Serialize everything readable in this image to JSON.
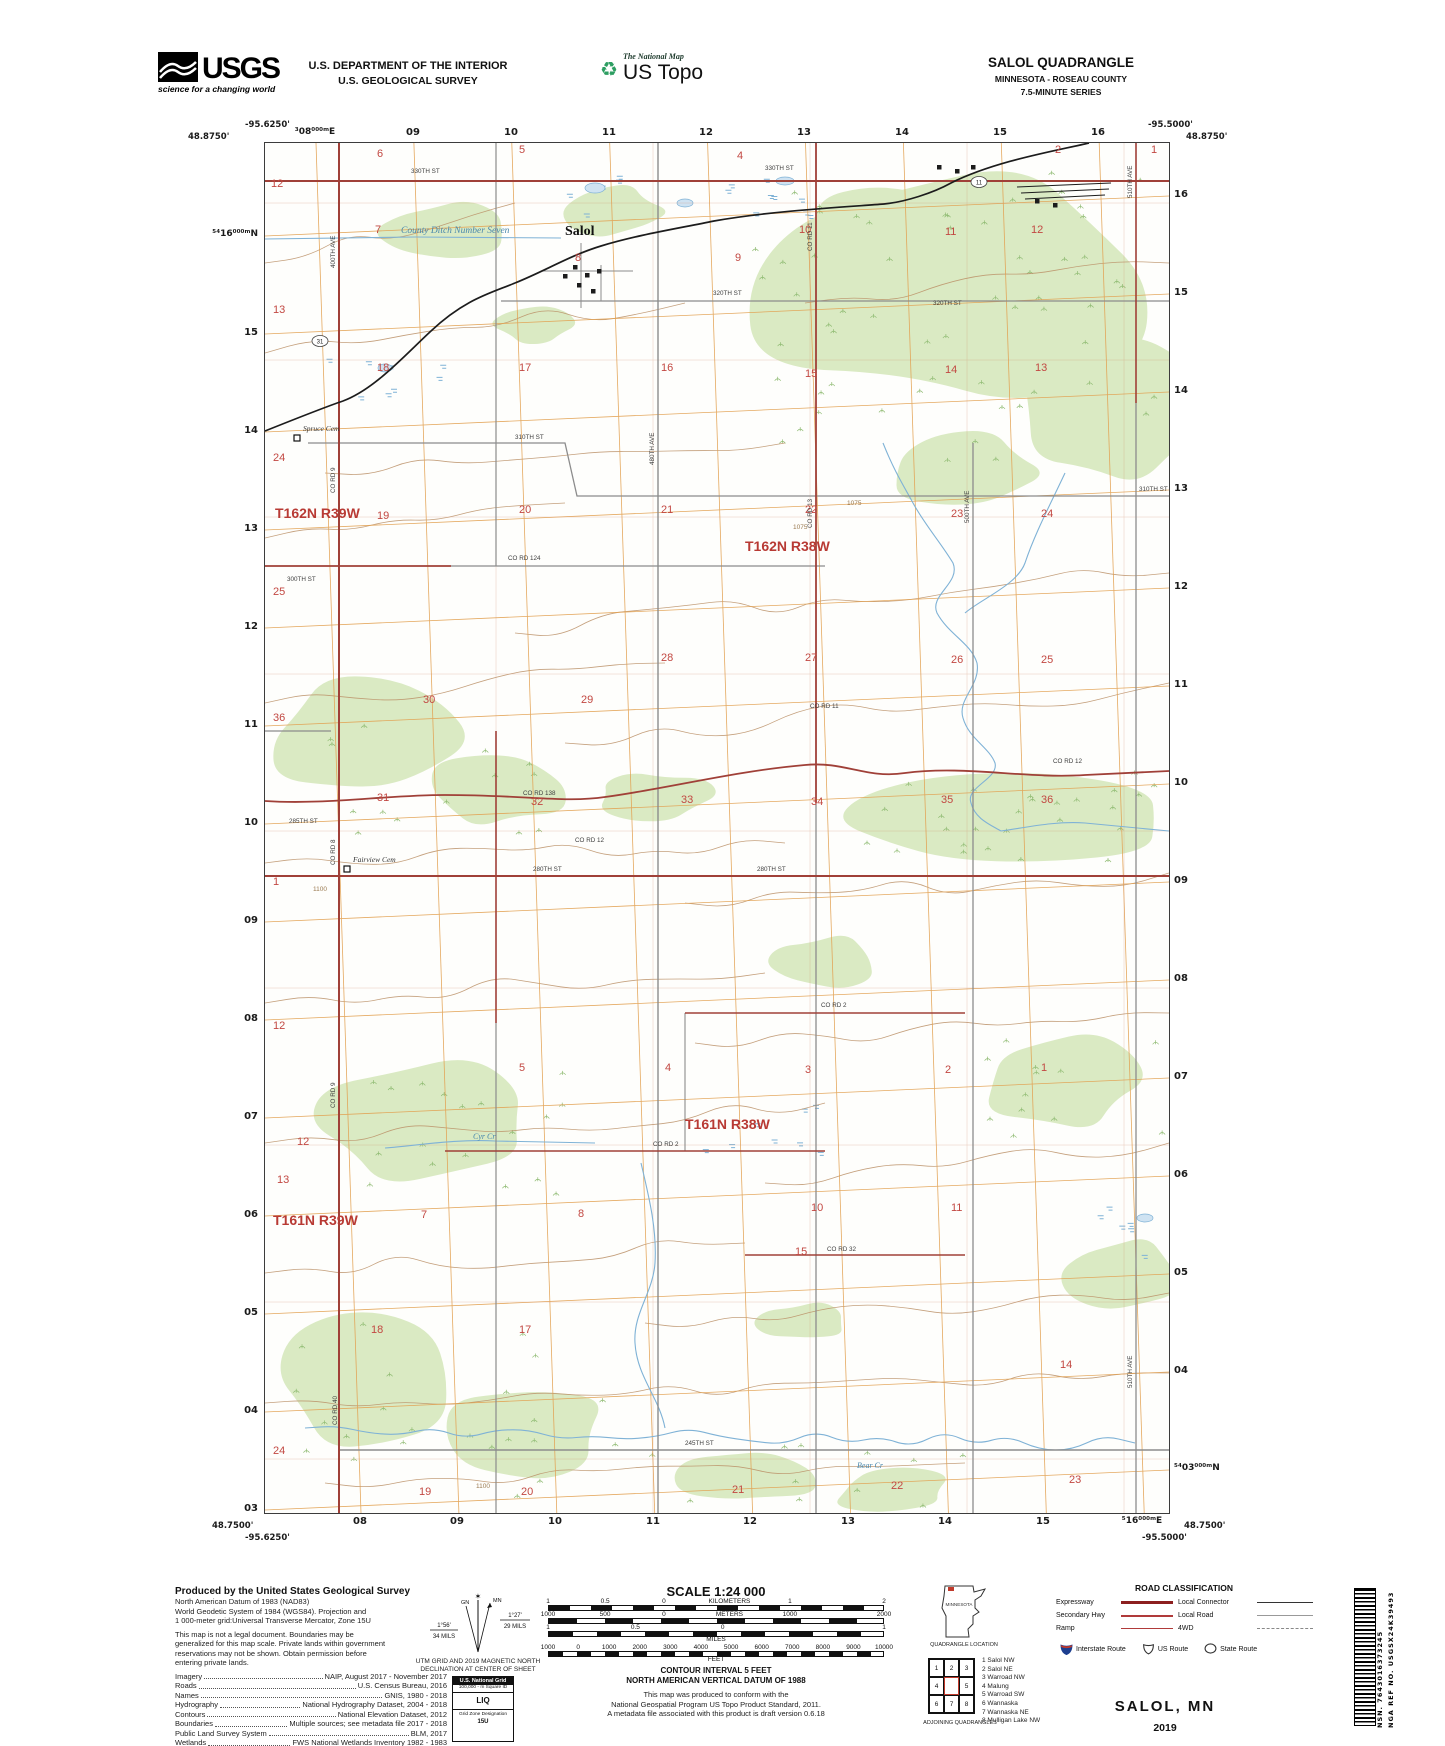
{
  "colors": {
    "veg": "#daeac3",
    "tuft": "#8fbb72",
    "contour": "#bb9067",
    "contour_label": "#9a7a50",
    "water": "#7fb2d6",
    "water_text": "#4a88ad",
    "grid": "#e2a050",
    "section_grid": "#d08a6a",
    "road_red": "#a04038",
    "road_gray": "#8c8c8c",
    "rail": "#1c1c1c",
    "section_num": "#c24842",
    "township": "#b83a34"
  },
  "header": {
    "usgs": {
      "brand": "USGS",
      "tagline": "science for a changing world"
    },
    "department_line1": "U.S. DEPARTMENT OF THE INTERIOR",
    "department_line2": "U.S. GEOLOGICAL SURVEY",
    "national_map": {
      "line1": "The National Map",
      "line2": "US Topo",
      "glyph": "♻"
    },
    "quadrangle": {
      "title": "SALOL QUADRANGLE",
      "subtitle1": "MINNESOTA - ROSEAU COUNTY",
      "subtitle2": "7.5-MINUTE SERIES"
    }
  },
  "map_frame": {
    "corners": {
      "top_left_lon": "-95.6250'",
      "top_left_lat": "48.8750'",
      "top_right_lon": "-95.5000'",
      "top_right_lat": "48.8750'",
      "bottom_left_lat": "48.7500'",
      "bottom_left_lon": "-95.6250'",
      "bottom_right_lat": "48.7500'",
      "bottom_right_lon": "-95.5000'"
    },
    "top_ticks": [
      {
        "t": "³08⁰⁰⁰ᵐE",
        "x": 51
      },
      {
        "t": "09",
        "x": 149
      },
      {
        "t": "10",
        "x": 247
      },
      {
        "t": "11",
        "x": 345
      },
      {
        "t": "12",
        "x": 442
      },
      {
        "t": "13",
        "x": 540
      },
      {
        "t": "14",
        "x": 638
      },
      {
        "t": "15",
        "x": 736
      },
      {
        "t": "16",
        "x": 834
      }
    ],
    "bottom_ticks": [
      {
        "t": "08",
        "x": 96
      },
      {
        "t": "09",
        "x": 193
      },
      {
        "t": "10",
        "x": 291
      },
      {
        "t": "11",
        "x": 389
      },
      {
        "t": "12",
        "x": 486
      },
      {
        "t": "13",
        "x": 584
      },
      {
        "t": "14",
        "x": 681
      },
      {
        "t": "15",
        "x": 779
      },
      {
        "t": "⁵16⁰⁰⁰ᵐE",
        "x": 878
      }
    ],
    "left_ticks": [
      {
        "t": "⁵⁴16⁰⁰⁰ᵐN",
        "y": 93
      },
      {
        "t": "15",
        "y": 191
      },
      {
        "t": "14",
        "y": 289
      },
      {
        "t": "13",
        "y": 387
      },
      {
        "t": "12",
        "y": 485
      },
      {
        "t": "11",
        "y": 583
      },
      {
        "t": "10",
        "y": 681
      },
      {
        "t": "09",
        "y": 779
      },
      {
        "t": "08",
        "y": 877
      },
      {
        "t": "07",
        "y": 975
      },
      {
        "t": "06",
        "y": 1073
      },
      {
        "t": "05",
        "y": 1171
      },
      {
        "t": "04",
        "y": 1269
      },
      {
        "t": "03",
        "y": 1367
      }
    ],
    "right_ticks": [
      {
        "t": "16",
        "y": 53
      },
      {
        "t": "15",
        "y": 151
      },
      {
        "t": "14",
        "y": 249
      },
      {
        "t": "13",
        "y": 347
      },
      {
        "t": "12",
        "y": 445
      },
      {
        "t": "11",
        "y": 543
      },
      {
        "t": "10",
        "y": 641
      },
      {
        "t": "09",
        "y": 739
      },
      {
        "t": "08",
        "y": 837
      },
      {
        "t": "07",
        "y": 935
      },
      {
        "t": "06",
        "y": 1033
      },
      {
        "t": "05",
        "y": 1131
      },
      {
        "t": "04",
        "y": 1229
      },
      {
        "t": "⁵⁴03⁰⁰⁰ᵐN",
        "y": 1327
      }
    ]
  },
  "map_labels": {
    "town": {
      "t": "Salol",
      "x": 300,
      "y": 92
    },
    "townships": [
      {
        "t": "T162N R39W",
        "x": 10,
        "y": 375
      },
      {
        "t": "T162N R38W",
        "x": 480,
        "y": 408
      },
      {
        "t": "T161N R39W",
        "x": 8,
        "y": 1082
      },
      {
        "t": "T161N R38W",
        "x": 420,
        "y": 986
      }
    ],
    "sections": [
      {
        "t": "12",
        "x": 6,
        "y": 44
      },
      {
        "t": "13",
        "x": 8,
        "y": 170
      },
      {
        "t": "24",
        "x": 8,
        "y": 318
      },
      {
        "t": "25",
        "x": 8,
        "y": 452
      },
      {
        "t": "36",
        "x": 8,
        "y": 578
      },
      {
        "t": "1",
        "x": 8,
        "y": 742
      },
      {
        "t": "12",
        "x": 8,
        "y": 886
      },
      {
        "t": "13",
        "x": 12,
        "y": 1040
      },
      {
        "t": "24",
        "x": 8,
        "y": 1311
      },
      {
        "t": "6",
        "x": 112,
        "y": 14
      },
      {
        "t": "5",
        "x": 254,
        "y": 10
      },
      {
        "t": "4",
        "x": 472,
        "y": 16
      },
      {
        "t": "2",
        "x": 790,
        "y": 10
      },
      {
        "t": "1",
        "x": 886,
        "y": 10
      },
      {
        "t": "7",
        "x": 110,
        "y": 90
      },
      {
        "t": "8",
        "x": 310,
        "y": 118
      },
      {
        "t": "9",
        "x": 470,
        "y": 118
      },
      {
        "t": "10",
        "x": 534,
        "y": 90
      },
      {
        "t": "11",
        "x": 680,
        "y": 92
      },
      {
        "t": "12",
        "x": 766,
        "y": 90
      },
      {
        "t": "18",
        "x": 112,
        "y": 228
      },
      {
        "t": "17",
        "x": 254,
        "y": 228
      },
      {
        "t": "16",
        "x": 396,
        "y": 228
      },
      {
        "t": "15",
        "x": 540,
        "y": 234
      },
      {
        "t": "14",
        "x": 680,
        "y": 230
      },
      {
        "t": "13",
        "x": 770,
        "y": 228
      },
      {
        "t": "19",
        "x": 112,
        "y": 376
      },
      {
        "t": "20",
        "x": 254,
        "y": 370
      },
      {
        "t": "21",
        "x": 396,
        "y": 370
      },
      {
        "t": "22",
        "x": 540,
        "y": 370
      },
      {
        "t": "23",
        "x": 686,
        "y": 374
      },
      {
        "t": "24",
        "x": 776,
        "y": 374
      },
      {
        "t": "30",
        "x": 158,
        "y": 560
      },
      {
        "t": "29",
        "x": 316,
        "y": 560
      },
      {
        "t": "28",
        "x": 396,
        "y": 518
      },
      {
        "t": "27",
        "x": 540,
        "y": 518
      },
      {
        "t": "26",
        "x": 686,
        "y": 520
      },
      {
        "t": "25",
        "x": 776,
        "y": 520
      },
      {
        "t": "31",
        "x": 112,
        "y": 658
      },
      {
        "t": "32",
        "x": 266,
        "y": 662
      },
      {
        "t": "33",
        "x": 416,
        "y": 660
      },
      {
        "t": "34",
        "x": 546,
        "y": 662
      },
      {
        "t": "35",
        "x": 676,
        "y": 660
      },
      {
        "t": "36",
        "x": 776,
        "y": 660
      },
      {
        "t": "5",
        "x": 254,
        "y": 928
      },
      {
        "t": "4",
        "x": 400,
        "y": 928
      },
      {
        "t": "3",
        "x": 540,
        "y": 930
      },
      {
        "t": "2",
        "x": 680,
        "y": 930
      },
      {
        "t": "1",
        "x": 776,
        "y": 928
      },
      {
        "t": "12",
        "x": 32,
        "y": 1002
      },
      {
        "t": "7",
        "x": 156,
        "y": 1075
      },
      {
        "t": "8",
        "x": 313,
        "y": 1074
      },
      {
        "t": "10",
        "x": 546,
        "y": 1068
      },
      {
        "t": "11",
        "x": 686,
        "y": 1068
      },
      {
        "t": "18",
        "x": 106,
        "y": 1190
      },
      {
        "t": "17",
        "x": 254,
        "y": 1190
      },
      {
        "t": "15",
        "x": 530,
        "y": 1112
      },
      {
        "t": "14",
        "x": 795,
        "y": 1225
      },
      {
        "t": "19",
        "x": 154,
        "y": 1352
      },
      {
        "t": "20",
        "x": 256,
        "y": 1352
      },
      {
        "t": "21",
        "x": 467,
        "y": 1350
      },
      {
        "t": "22",
        "x": 626,
        "y": 1346
      },
      {
        "t": "23",
        "x": 804,
        "y": 1340
      }
    ],
    "roads": [
      {
        "t": "330TH ST",
        "x": 146,
        "y": 30
      },
      {
        "t": "330TH ST",
        "x": 500,
        "y": 27
      },
      {
        "t": "320TH ST",
        "x": 448,
        "y": 152
      },
      {
        "t": "320TH ST",
        "x": 668,
        "y": 162
      },
      {
        "t": "310TH ST",
        "x": 250,
        "y": 296
      },
      {
        "t": "310TH ST",
        "x": 874,
        "y": 348
      },
      {
        "t": "CO RD 124",
        "x": 243,
        "y": 417
      },
      {
        "t": "300TH ST",
        "x": 22,
        "y": 438
      },
      {
        "t": "285TH ST",
        "x": 24,
        "y": 680
      },
      {
        "t": "CO RD 138",
        "x": 258,
        "y": 652
      },
      {
        "t": "CO RD 12",
        "x": 310,
        "y": 699
      },
      {
        "t": "CO RD 12",
        "x": 788,
        "y": 620
      },
      {
        "t": "CO RD 11",
        "x": 545,
        "y": 565
      },
      {
        "t": "280TH ST",
        "x": 268,
        "y": 728
      },
      {
        "t": "280TH ST",
        "x": 492,
        "y": 728
      },
      {
        "t": "CO RD 2",
        "x": 556,
        "y": 864
      },
      {
        "t": "CO RD 2",
        "x": 388,
        "y": 1003
      },
      {
        "t": "CO RD 32",
        "x": 562,
        "y": 1108
      },
      {
        "t": "245TH ST",
        "x": 420,
        "y": 1302
      },
      {
        "t": "400TH AVE",
        "x": 70,
        "y": 125,
        "r": 1
      },
      {
        "t": "CO RD 9",
        "x": 70,
        "y": 350,
        "r": 1
      },
      {
        "t": "CO RD 8",
        "x": 70,
        "y": 722,
        "r": 1
      },
      {
        "t": "CO RD 9",
        "x": 70,
        "y": 965,
        "r": 1
      },
      {
        "t": "CO RD 40",
        "x": 72,
        "y": 1282,
        "r": 1
      },
      {
        "t": "480TH AVE",
        "x": 389,
        "y": 322,
        "r": 1
      },
      {
        "t": "CO RD 11",
        "x": 547,
        "y": 108,
        "r": 1
      },
      {
        "t": "CO RD 13",
        "x": 547,
        "y": 385,
        "r": 1
      },
      {
        "t": "500TH AVE",
        "x": 704,
        "y": 380,
        "r": 1
      },
      {
        "t": "510TH AVE",
        "x": 867,
        "y": 55,
        "r": 1
      },
      {
        "t": "510TH AVE",
        "x": 867,
        "y": 1245,
        "r": 1
      }
    ],
    "badges": [
      {
        "t": "11",
        "x": 714,
        "y": 41
      },
      {
        "t": "31",
        "x": 55,
        "y": 200
      }
    ],
    "water": [
      {
        "t": "County Ditch Number Seven",
        "x": 136,
        "y": 90,
        "big": 1
      },
      {
        "t": "Cyr Cr",
        "x": 208,
        "y": 996
      },
      {
        "t": "Bear Cr",
        "x": 592,
        "y": 1325
      }
    ],
    "cemeteries": [
      {
        "t": "Spruce Cem",
        "x": 38,
        "y": 288
      },
      {
        "t": "Fairview Cem",
        "x": 88,
        "y": 719
      }
    ],
    "contour_labels": [
      {
        "t": "1075",
        "x": 528,
        "y": 386
      },
      {
        "t": "1075",
        "x": 582,
        "y": 362
      },
      {
        "t": "1100",
        "x": 48,
        "y": 748
      },
      {
        "t": "1100",
        "x": 211,
        "y": 1345
      }
    ]
  },
  "footer": {
    "produced_by": "Produced by the United States Geological Survey",
    "datum_lines": [
      "North American Datum of 1983 (NAD83)",
      "World Geodetic System of 1984 (WGS84).  Projection and",
      "1 000-meter grid:Universal Transverse Mercator, Zone 15U"
    ],
    "legal_lines": [
      "This map is not a legal document. Boundaries may be",
      "generalized for this map scale. Private lands within government",
      "reservations may not be shown. Obtain permission before",
      "entering private lands."
    ],
    "sources": [
      {
        "k": "Imagery",
        "v": "NAIP, August 2017 - November 2017"
      },
      {
        "k": "Roads",
        "v": "U.S. Census Bureau, 2016"
      },
      {
        "k": "Names",
        "v": "GNIS, 1980 - 2018"
      },
      {
        "k": "Hydrography",
        "v": "National Hydrography Dataset, 2004 - 2018"
      },
      {
        "k": "Contours",
        "v": "National Elevation Dataset, 2012"
      },
      {
        "k": "Boundaries",
        "v": "Multiple sources; see metadata file 2017 - 2018"
      },
      {
        "k": "Public Land Survey System",
        "v": "BLM, 2017"
      },
      {
        "k": "Wetlands",
        "v": "FWS National Wetlands Inventory 1982 - 1983"
      }
    ],
    "declination": {
      "gn_label": "GN",
      "mn_label": "MN",
      "star": "✶",
      "gn_deg": "1°56'",
      "gn_mils": "34 MILS",
      "mn_deg": "1°27'",
      "mn_mils": "29 MILS",
      "cap1": "UTM GRID AND 2019 MAGNETIC NORTH",
      "cap2": "DECLINATION AT CENTER OF SHEET"
    },
    "usng": {
      "title": "U.S. National Grid",
      "sub": "100,000 - m Square ID",
      "square": "LIQ",
      "zone_label": "Grid Zone Designation",
      "zone": "15U"
    },
    "scale": {
      "title": "SCALE 1:24 000",
      "rows": [
        {
          "labels": [
            {
              "t": "1",
              "f": 0
            },
            {
              "t": "0.5",
              "f": 0.17
            },
            {
              "t": "0",
              "f": 0.345
            },
            {
              "t": "KILOMETERS",
              "f": 0.54
            },
            {
              "t": "1",
              "f": 0.72
            },
            {
              "t": "2",
              "f": 1
            }
          ],
          "seg": 21,
          "below": ""
        },
        {
          "labels": [
            {
              "t": "1000",
              "f": 0
            },
            {
              "t": "500",
              "f": 0.17
            },
            {
              "t": "0",
              "f": 0.345
            },
            {
              "t": "METERS",
              "f": 0.54
            },
            {
              "t": "1000",
              "f": 0.72
            },
            {
              "t": "2000",
              "f": 1
            }
          ],
          "seg": 28,
          "below": ""
        },
        {
          "labels": [
            {
              "t": "1",
              "f": 0
            },
            {
              "t": "0.5",
              "f": 0.26
            },
            {
              "t": "0",
              "f": 0.52
            },
            {
              "t": "1",
              "f": 1
            }
          ],
          "seg": 24,
          "below": "MILES"
        },
        {
          "labels": [
            {
              "t": "1000",
              "f": 0
            },
            {
              "t": "0",
              "f": 0.09
            },
            {
              "t": "1000",
              "f": 0.182
            },
            {
              "t": "2000",
              "f": 0.273
            },
            {
              "t": "3000",
              "f": 0.364
            },
            {
              "t": "4000",
              "f": 0.455
            },
            {
              "t": "5000",
              "f": 0.545
            },
            {
              "t": "6000",
              "f": 0.636
            },
            {
              "t": "7000",
              "f": 0.727
            },
            {
              "t": "8000",
              "f": 0.818
            },
            {
              "t": "9000",
              "f": 0.909
            },
            {
              "t": "10000",
              "f": 1
            }
          ],
          "seg": 14,
          "below": "FEET"
        }
      ]
    },
    "notes": {
      "contour1": "CONTOUR INTERVAL 5 FEET",
      "contour2": "NORTH AMERICAN VERTICAL DATUM OF 1988",
      "conform": [
        "This map was produced to conform with the",
        "National Geospatial Program US Topo Product Standard, 2011.",
        "A metadata file associated with this product is draft version 0.6.18"
      ]
    },
    "location": {
      "state": "MINNESOTA",
      "caption": "QUADRANGLE LOCATION"
    },
    "adjoining": {
      "caption": "ADJOINING QUADRANGLES",
      "cells": [
        "1",
        "2",
        "3",
        "4",
        "",
        "5",
        "6",
        "7",
        "8"
      ],
      "list": [
        "1 Salol NW",
        "2 Salol NE",
        "3 Warroad NW",
        "4 Malung",
        "5 Warroad SW",
        "6 Wannaska",
        "7 Wannaska NE",
        "8 Mulligan Lake NW"
      ]
    },
    "road_class": {
      "title": "ROAD CLASSIFICATION",
      "rows": [
        {
          "label": "Expressway",
          "style": "expressway"
        },
        {
          "label": "Local Connector",
          "style": "connector"
        },
        {
          "label": "Secondary Hwy",
          "style": "secondary"
        },
        {
          "label": "Local Road",
          "style": "local"
        },
        {
          "label": "Ramp",
          "style": "ramp"
        },
        {
          "label": "4WD",
          "style": "fourwd"
        }
      ],
      "shields": [
        {
          "label": "Interstate Route",
          "kind": "interstate"
        },
        {
          "label": "US Route",
          "kind": "us"
        },
        {
          "label": "State Route",
          "kind": "state"
        }
      ]
    },
    "imprint": {
      "name": "SALOL,  MN",
      "year": "2019"
    },
    "barcode": {
      "nsn": "NSN.  7643016373245",
      "nga": "NGA REF NO.  USGSX24K39493"
    }
  }
}
